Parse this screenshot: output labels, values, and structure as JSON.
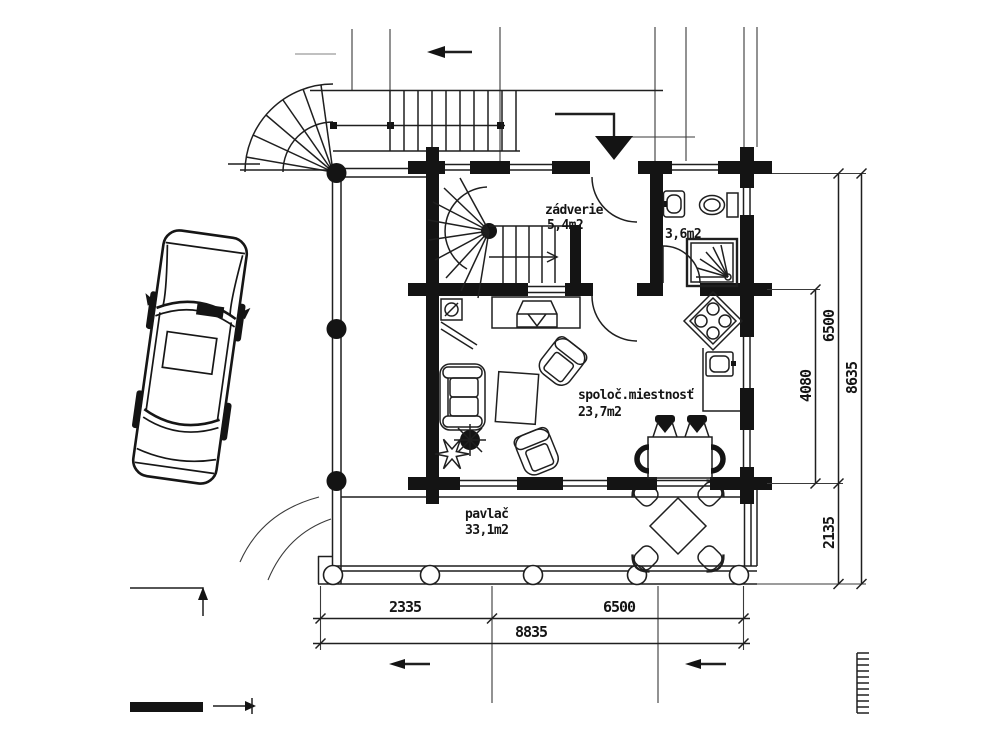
{
  "drawing_title": "log-house ground floor plan with parked car",
  "labels": {
    "entry_name": "zádverie",
    "entry_area": "5,4m2",
    "bathroom_area": "3,6m2",
    "living_name": "spoloč.miestnosť",
    "living_area": "23,7m2",
    "porch_name": "pavlač",
    "porch_area": "33,1m2"
  },
  "dimensions": {
    "bottom_left_segment": "2335",
    "bottom_right_segment": "6500",
    "bottom_total": "8835",
    "right_living_depth": "4080",
    "right_house_depth": "6500",
    "right_porch_depth": "2135",
    "right_total": "8635"
  },
  "colors": {
    "line": "#1f1f1f",
    "background": "#ffffff"
  }
}
